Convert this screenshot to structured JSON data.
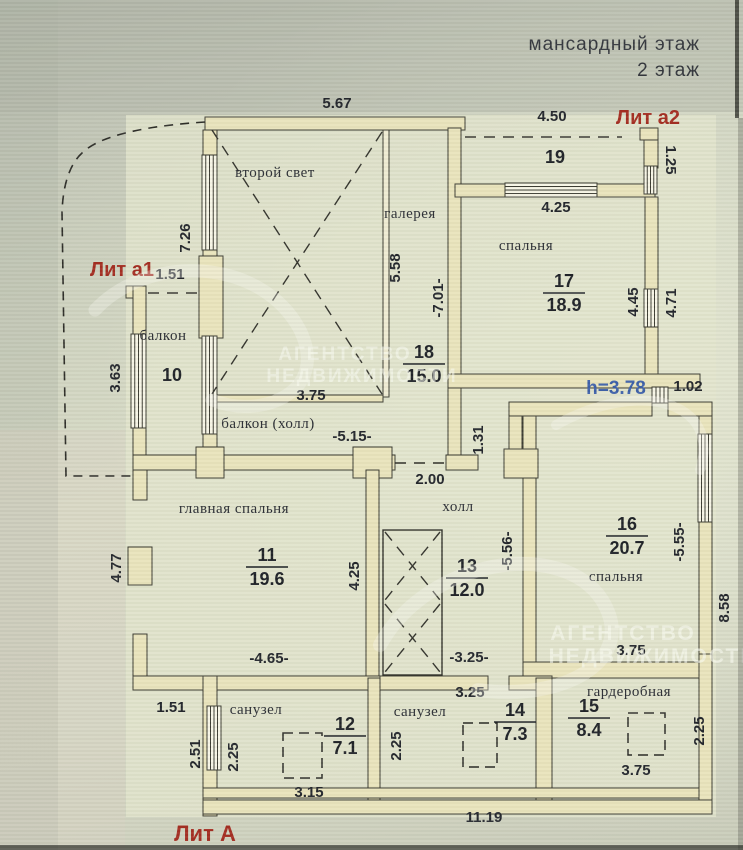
{
  "header": {
    "floor_title_line1": "мансардный этаж",
    "floor_title_line2": "2 этаж"
  },
  "legend_marks": {
    "lit_a2": "Лит а2",
    "lit_a1": "Лит а1",
    "lit_a": "Лит А",
    "ceiling_height": "h=3.78"
  },
  "watermark": {
    "agency_line1": "АГЕНТСТВО",
    "agency_line2": "НЕДВИЖИМОСТИ"
  },
  "colors": {
    "wall_fill": "#e9e4bc",
    "paper": "#d5d8c4",
    "ink": "#23262c",
    "lit_red": "#a42d22",
    "note_blue": "#3d60a9"
  },
  "plan": {
    "room_labels": [
      {
        "t": "второй свет",
        "x": 275,
        "y": 177
      },
      {
        "t": "галерея",
        "x": 410,
        "y": 218
      },
      {
        "t": "спальня",
        "x": 526,
        "y": 250
      },
      {
        "t": "балкон",
        "x": 163,
        "y": 340
      },
      {
        "t": "балкон (холл)",
        "x": 268,
        "y": 428
      },
      {
        "t": "холл",
        "x": 458,
        "y": 511
      },
      {
        "t": "главная спальня",
        "x": 234,
        "y": 513
      },
      {
        "t": "спальня",
        "x": 616,
        "y": 581
      },
      {
        "t": "санузел",
        "x": 256,
        "y": 714
      },
      {
        "t": "санузел",
        "x": 420,
        "y": 716
      },
      {
        "t": "гардеробная",
        "x": 629,
        "y": 696
      },
      {
        "t": "19",
        "x": 555,
        "y": 163,
        "cls": "num"
      },
      {
        "t": "10",
        "x": 172,
        "y": 381,
        "cls": "num"
      }
    ],
    "room_stats": [
      {
        "num": "18",
        "area": "15.0",
        "x": 424,
        "y": 358
      },
      {
        "num": "17",
        "area": "18.9",
        "x": 564,
        "y": 287
      },
      {
        "num": "11",
        "area": "19.6",
        "x": 267,
        "y": 561
      },
      {
        "num": "13",
        "area": "12.0",
        "x": 467,
        "y": 572
      },
      {
        "num": "16",
        "area": "20.7",
        "x": 627,
        "y": 530
      },
      {
        "num": "12",
        "area": "7.1",
        "x": 345,
        "y": 730
      },
      {
        "num": "14",
        "area": "7.3",
        "x": 515,
        "y": 716
      },
      {
        "num": "15",
        "area": "8.4",
        "x": 589,
        "y": 712
      }
    ],
    "dims": [
      {
        "t": "5.67",
        "x": 337,
        "y": 108
      },
      {
        "t": "4.50",
        "x": 552,
        "y": 121
      },
      {
        "t": "1.25",
        "x": 666,
        "y": 160,
        "r": 90
      },
      {
        "t": "4.25",
        "x": 556,
        "y": 212
      },
      {
        "t": "7.26",
        "x": 190,
        "y": 238,
        "r": -90
      },
      {
        "t": "1.51",
        "x": 170,
        "y": 279
      },
      {
        "t": "5.58",
        "x": 400,
        "y": 268,
        "r": -90
      },
      {
        "t": "-7.01-",
        "x": 443,
        "y": 298,
        "r": -90
      },
      {
        "t": "4.45",
        "x": 638,
        "y": 302,
        "r": -90
      },
      {
        "t": "4.71",
        "x": 676,
        "y": 303,
        "r": -90
      },
      {
        "t": "3.63",
        "x": 120,
        "y": 378,
        "r": -90
      },
      {
        "t": "3.75",
        "x": 311,
        "y": 400
      },
      {
        "t": "1.02",
        "x": 688,
        "y": 391
      },
      {
        "t": "-5.15-",
        "x": 352,
        "y": 441
      },
      {
        "t": "1.31",
        "x": 483,
        "y": 440,
        "r": -90
      },
      {
        "t": "2.00",
        "x": 430,
        "y": 484
      },
      {
        "t": "4.77",
        "x": 121,
        "y": 568,
        "r": -90
      },
      {
        "t": "4.25",
        "x": 359,
        "y": 576,
        "r": -90
      },
      {
        "t": "-5.56-",
        "x": 512,
        "y": 551,
        "r": -90
      },
      {
        "t": "-5.55-",
        "x": 684,
        "y": 542,
        "r": -90
      },
      {
        "t": "8.58",
        "x": 729,
        "y": 608,
        "r": -90
      },
      {
        "t": "-4.65-",
        "x": 269,
        "y": 663
      },
      {
        "t": "-3.25-",
        "x": 469,
        "y": 662
      },
      {
        "t": "3.25",
        "x": 470,
        "y": 697
      },
      {
        "t": "3.75",
        "x": 631,
        "y": 655
      },
      {
        "t": "1.51",
        "x": 171,
        "y": 712
      },
      {
        "t": "2.51",
        "x": 200,
        "y": 754,
        "r": -90
      },
      {
        "t": "2.25",
        "x": 238,
        "y": 757,
        "r": -90
      },
      {
        "t": "2.25",
        "x": 401,
        "y": 746,
        "r": -90
      },
      {
        "t": "2.25",
        "x": 704,
        "y": 731,
        "r": -90
      },
      {
        "t": "3.15",
        "x": 309,
        "y": 797
      },
      {
        "t": "3.75",
        "x": 636,
        "y": 775
      },
      {
        "t": "11.19",
        "x": 484,
        "y": 822
      }
    ]
  }
}
